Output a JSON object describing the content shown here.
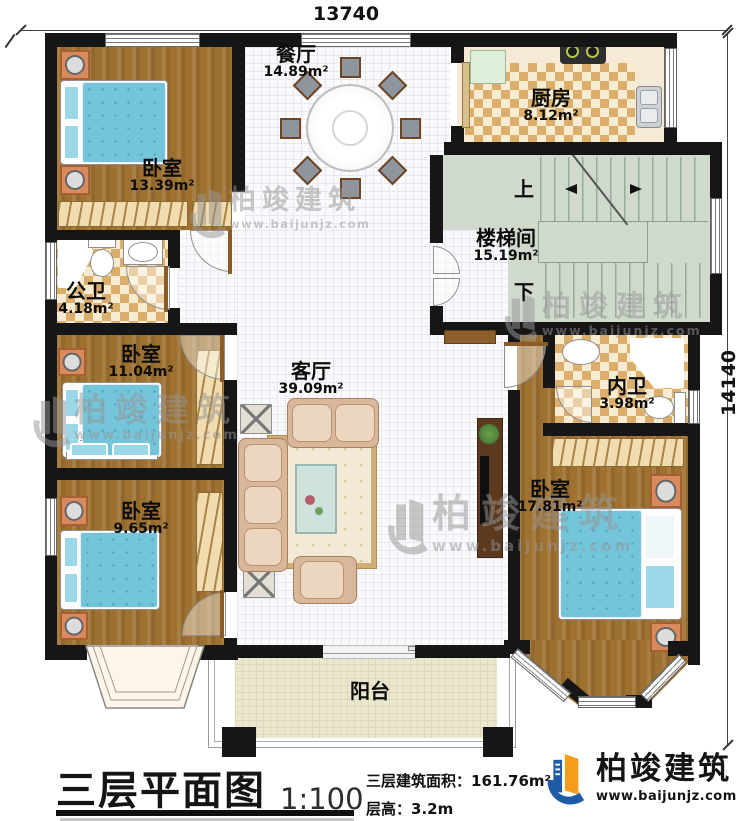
{
  "plan": {
    "top_dimension": "13740",
    "right_dimension": "14140",
    "rooms": {
      "bedroom_top_left": {
        "name": "卧室",
        "area": "13.39m²"
      },
      "dining": {
        "name": "餐厅",
        "area": "14.89m²"
      },
      "kitchen": {
        "name": "厨房",
        "area": "8.12m²"
      },
      "stairwell": {
        "name": "楼梯间",
        "area": "15.19m²",
        "up": "上",
        "down": "下"
      },
      "public_bath": {
        "name": "公卫",
        "area": "4.18m²"
      },
      "bedroom_mid_left": {
        "name": "卧室",
        "area": "11.04m²"
      },
      "bedroom_bottom_left": {
        "name": "卧室",
        "area": "9.65m²"
      },
      "living": {
        "name": "客厅",
        "area": "39.09m²"
      },
      "inner_bath": {
        "name": "内卫",
        "area": "3.98m²"
      },
      "bedroom_right": {
        "name": "卧室",
        "area": "17.81m²"
      },
      "balcony": {
        "name": "阳台"
      }
    }
  },
  "title_block": {
    "title": "三层平面图",
    "scale": "1:100",
    "floor_area_label": "三层建筑面积：",
    "floor_area_value": "161.76m²",
    "floor_height_label": "层高：",
    "floor_height_value": "3.2m"
  },
  "brand": {
    "name": "柏竣建筑",
    "website": "www.baijunjz.com"
  },
  "watermark": {
    "name": "柏竣建筑",
    "website": "www.baijunjz.com"
  },
  "colors": {
    "wall": "#161616",
    "wood_floor": "#9e7130",
    "checker_tile": "#dcae6b",
    "stair_floor": "#cfdacd",
    "balcony_floor": "#ebe7ce",
    "bed_blue": "#74c5da",
    "nightstand_orange": "#d98a5c",
    "logo_blue": "#1d5ba6",
    "logo_orange": "#f59d1a"
  }
}
